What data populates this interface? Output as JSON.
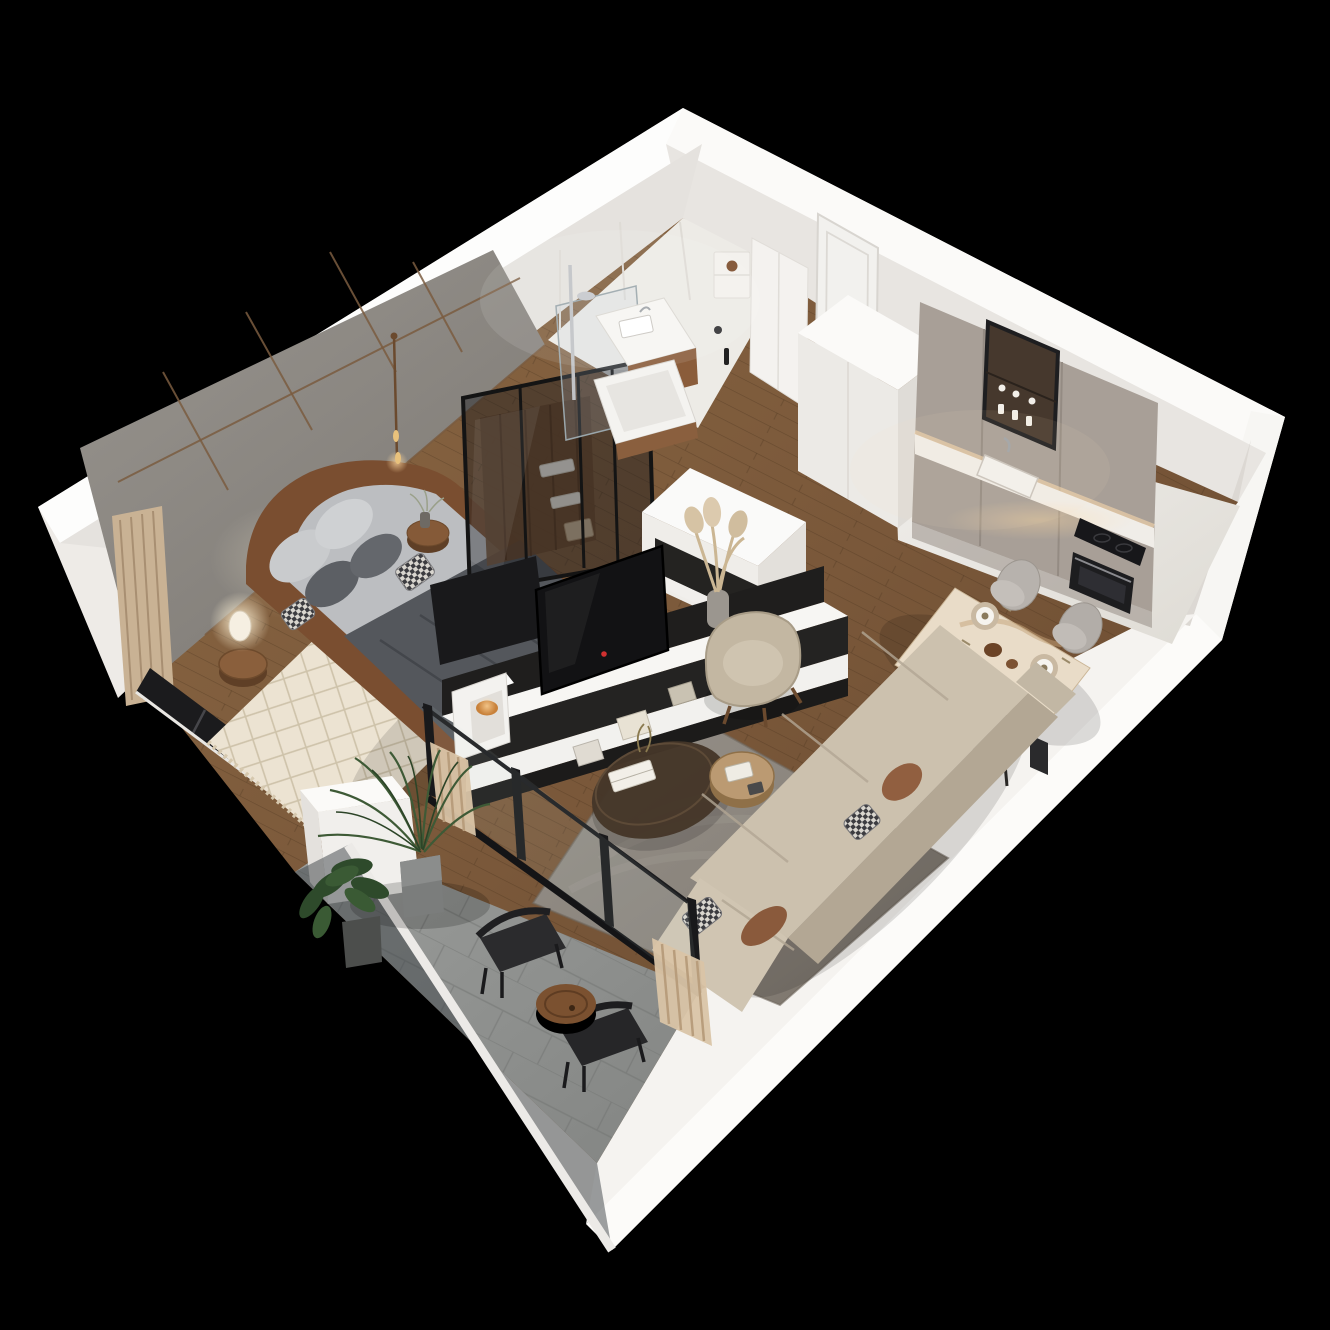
{
  "scene": {
    "title": "3D isometric cutaway floor plan render of a one-bedroom apartment on a black background",
    "view": "top-down isometric perspective, apartment rotated like a diamond",
    "background_color": "#000000",
    "rooms": [
      {
        "name": "Bedroom",
        "floor": "walnut wood planks",
        "features": [
          "double bed with curved brown leather frame",
          "light gray bedding",
          "dark gray throw blanket",
          "gray and checkered pillows",
          "cream diamond-pattern rug with fringe",
          "round wooden side stool with white table lamp",
          "round wooden stool with flower vase",
          "brass pendant light",
          "gray wall panels with wood-tone trim",
          "beige floor curtain",
          "black framed corner window"
        ]
      },
      {
        "name": "Walk-in closet",
        "floor": "wood",
        "features": [
          "black framed smoked-glass wardrobe",
          "wooden back panel",
          "shelves with folded linen",
          "storage basket"
        ]
      },
      {
        "name": "Bathroom",
        "floor": "white stone",
        "features": [
          "walk-in shower with chrome column and glass screen",
          "white basin on wooden vanity",
          "bathtub with wood side panel",
          "wall niche with jar decor",
          "black toilet brush and roll holder"
        ]
      },
      {
        "name": "Hallway",
        "floor": "wood",
        "features": [
          "white entrance door",
          "tall white wardrobe cabinet block"
        ]
      },
      {
        "name": "Kitchen",
        "floor": "white marble",
        "features": [
          "taupe handleless cabinet run",
          "black framed glass display cabinet with glassware",
          "undermount sink with chrome faucet",
          "white stone countertop with under-cabinet lighting",
          "black induction cooktop",
          "built-in black oven"
        ]
      },
      {
        "name": "Dining area",
        "floor": "wood",
        "seats": 4,
        "features": [
          "beige marble dining table with black legs",
          "four place settings with gold chargers",
          "four gray upholstered chairs"
        ]
      },
      {
        "name": "Living room",
        "floor": "wood",
        "features": [
          "large gray area rug",
          "beige L-shaped sectional sofa",
          "rust and checkered scatter cushions",
          "dark organic-shaped coffee table with books",
          "round light-wood side table",
          "beige swivel armchair with wood legs",
          "black media partition with wall-mounted TV",
          "white media bench with frames and books",
          "white cube shelf with orange candle bowl",
          "pampas grass in gray vase",
          "white half wall with dark display niche"
        ]
      },
      {
        "name": "Balcony",
        "floor": "gray stone tiles",
        "features": [
          "frameless glass balustrade with white handrail",
          "palm plant in gray pot",
          "leafy green plant in dark pot",
          "two black outdoor chairs",
          "round wooden side table",
          "black framed sliding glass doors",
          "beige curtains"
        ]
      }
    ],
    "palette": {
      "background": "#000000",
      "wall_white": "#efece8",
      "wall_top_highlight": "#fdfdfc",
      "gray_panel_wall": "#8d8984",
      "panel_trim_wood": "#7a5c40",
      "floor_wood": "#7a583a",
      "floor_marble": "#eceae5",
      "floor_stone": "#909290",
      "rug_living": "#8a847c",
      "rug_bedroom": "#ece3d2",
      "sofa_beige": "#ccc1ae",
      "kitchen_cabinet_taupe": "#a89f97",
      "appliance_black": "#1b1b1d",
      "frame_black": "#19191b",
      "accent_wood": "#7b5130",
      "accent_candle_orange": "#c8813a",
      "plant_green": "#3e5a36"
    }
  }
}
